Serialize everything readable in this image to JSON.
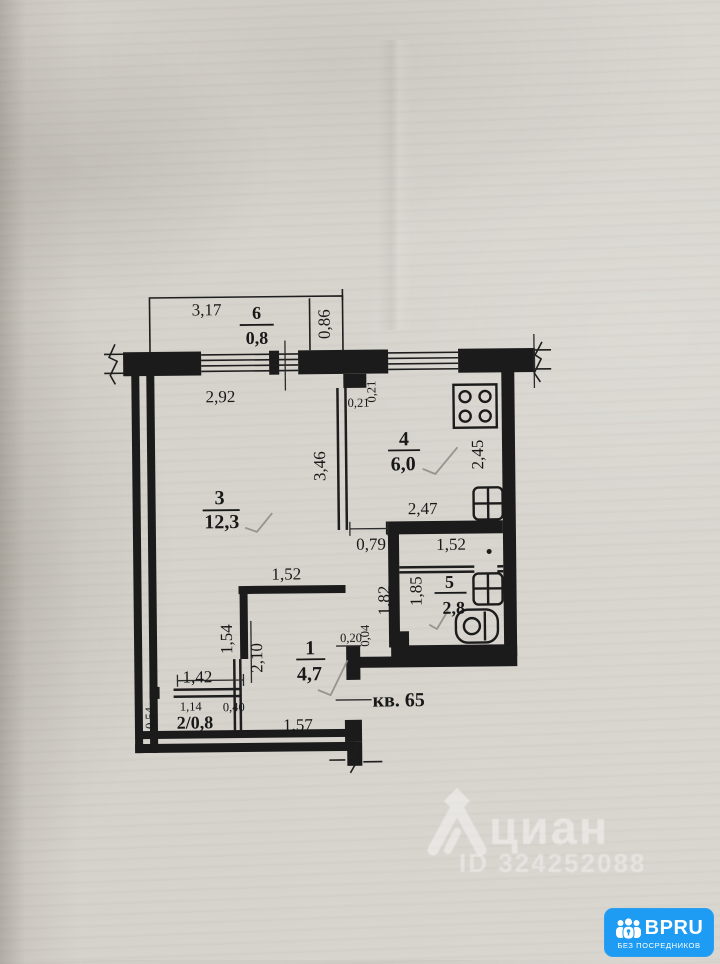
{
  "plan": {
    "apartment_label": "кв. 65",
    "rooms": {
      "r1": {
        "number": "1",
        "area": "4,7"
      },
      "r2": {
        "label": "2/0,8"
      },
      "r3": {
        "number": "3",
        "area": "12,3"
      },
      "r4": {
        "number": "4",
        "area": "6,0"
      },
      "r5": {
        "number": "5",
        "area": "2,8"
      },
      "r6": {
        "number": "6",
        "area": "0,8"
      }
    },
    "dimensions": {
      "balcony_width": "3,17",
      "balcony_depth": "0,86",
      "room3_top": "2,92",
      "notch_w": "0,21",
      "notch_d": "0,21",
      "room3_side": "3,46",
      "kitchen_side": "2,45",
      "kitchen_width": "2,47",
      "bath_vestibule_width": "1,52",
      "kitchen_doorway": "0,79",
      "bath_side": "1,85",
      "hall_side": "1,82",
      "room3_bottom": "1,52",
      "hall_wall_a": "1,54",
      "hall_wall_b": "2,10",
      "wall_stub_w": "0,20",
      "wall_stub_d": "0,04",
      "closet_top": "1,42",
      "closet_width": "1,14",
      "closet_door": "0,40",
      "closet_side": "0,54",
      "hall_bottom": "1,57"
    },
    "icons": {
      "stove": "stove-icon",
      "kitchen_sink": "sink-icon",
      "bath_sink": "sink-icon",
      "toilet": "toilet-icon"
    }
  },
  "watermark": {
    "brand": "циан",
    "listing_id": "ID 324252088"
  },
  "badge": {
    "brand": "BPRU",
    "tagline": "БЕЗ ПОСРЕДНИКОВ"
  }
}
